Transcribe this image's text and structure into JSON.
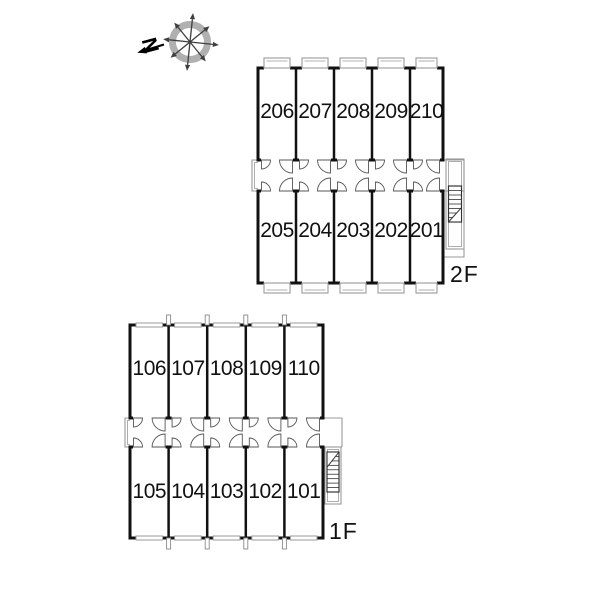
{
  "compass": {
    "label": "N"
  },
  "floors": [
    {
      "label": "2F",
      "top_row": [
        "206",
        "207",
        "208",
        "209",
        "210"
      ],
      "bottom_row": [
        "205",
        "204",
        "203",
        "202",
        "201"
      ]
    },
    {
      "label": "1F",
      "top_row": [
        "106",
        "107",
        "108",
        "109",
        "110"
      ],
      "bottom_row": [
        "105",
        "104",
        "103",
        "102",
        "101"
      ]
    }
  ],
  "colors": {
    "background": "#ffffff",
    "wall": "#111111",
    "light_line": "#999999",
    "door_arc": "#555555",
    "stair_line": "#333333",
    "compass_ring": "#b0b0b0",
    "compass_arrow": "#3f3f3f",
    "text": "#111111"
  }
}
